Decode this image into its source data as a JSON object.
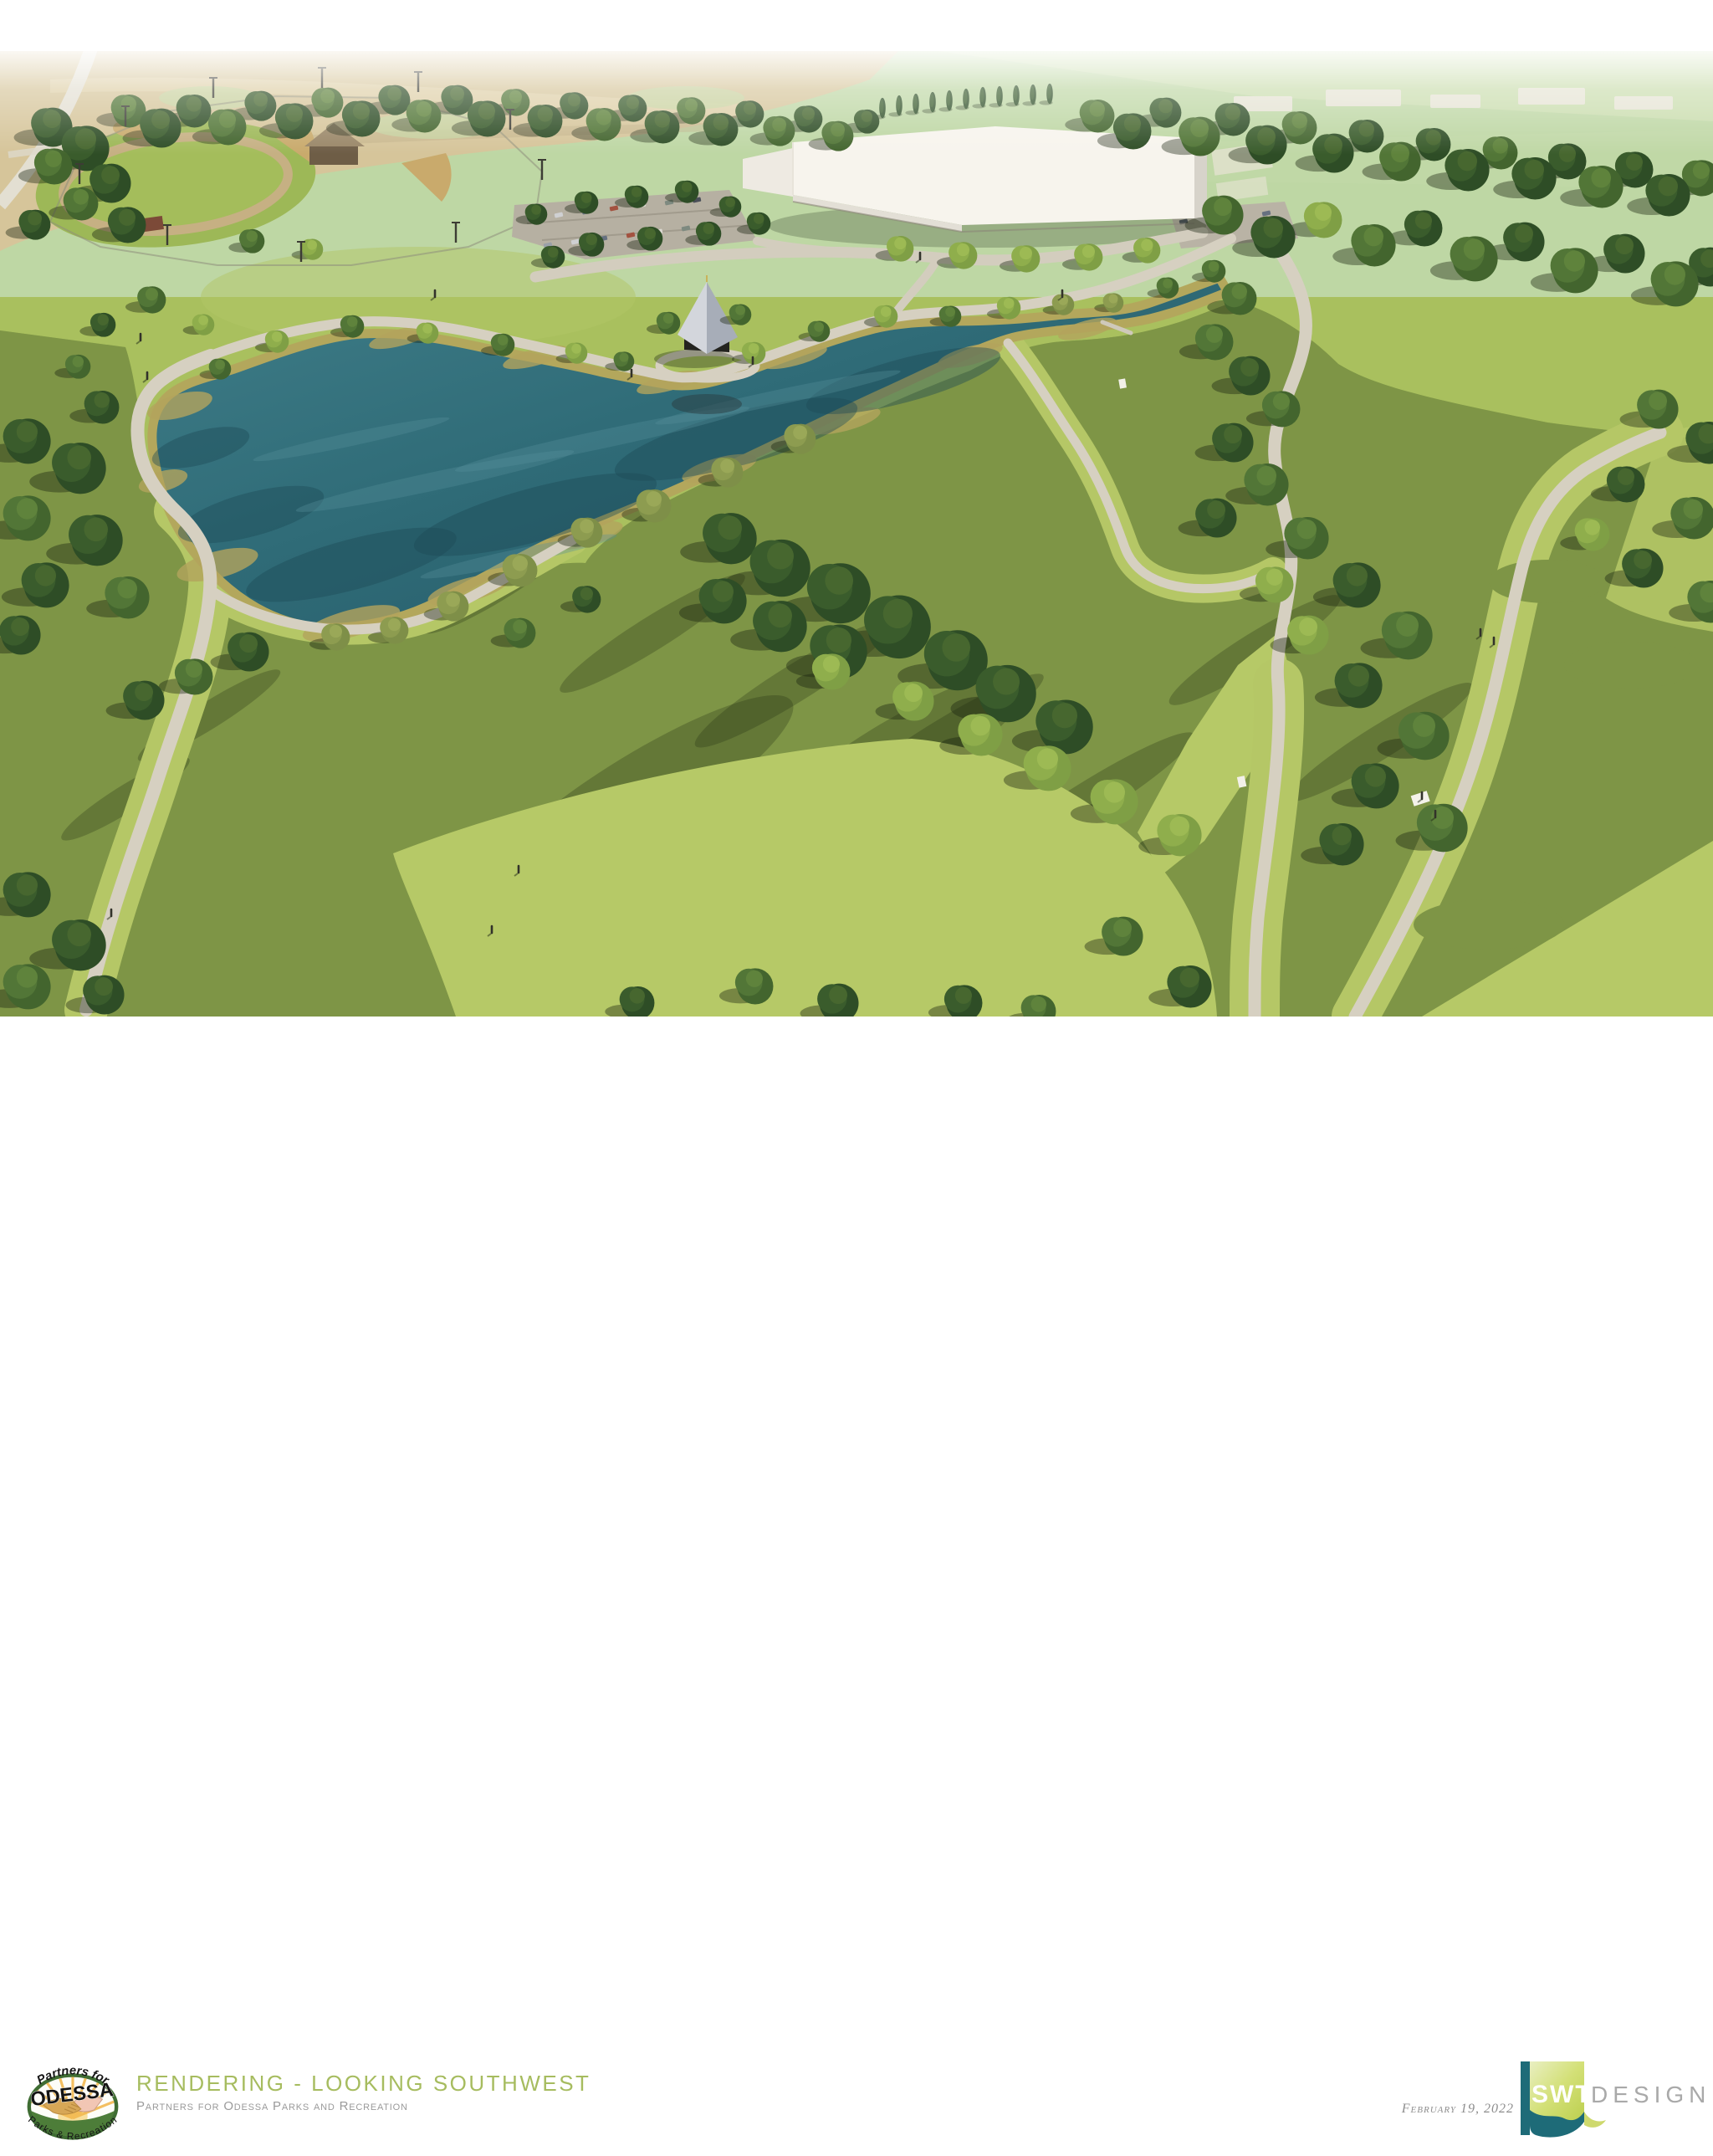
{
  "footer": {
    "title": "RENDERING - LOOKING SOUTHWEST",
    "subtitle": "Partners for Odessa Parks and Recreation",
    "date": "February 19, 2022",
    "client_logo": {
      "arc_top": "Partners for",
      "name": "ODESSA",
      "arc_bottom": "Parks & Recreation"
    },
    "firm_logo": {
      "initials": "SWT",
      "wordmark": "DESIGN"
    }
  },
  "colors": {
    "title_green": "#a6bc5f",
    "subtitle_gray": "#9a9a9a",
    "date_gray": "#8d8d8d",
    "firm_teal": "#1e6b78",
    "firm_lime": "#c9d75f",
    "lake_teal": "#2f6b77",
    "lawn_green": "#a9c05e",
    "meadow_olive": "#7e9546",
    "path_tan": "#d6d0c1",
    "wheat_field": "#d6c59a"
  }
}
